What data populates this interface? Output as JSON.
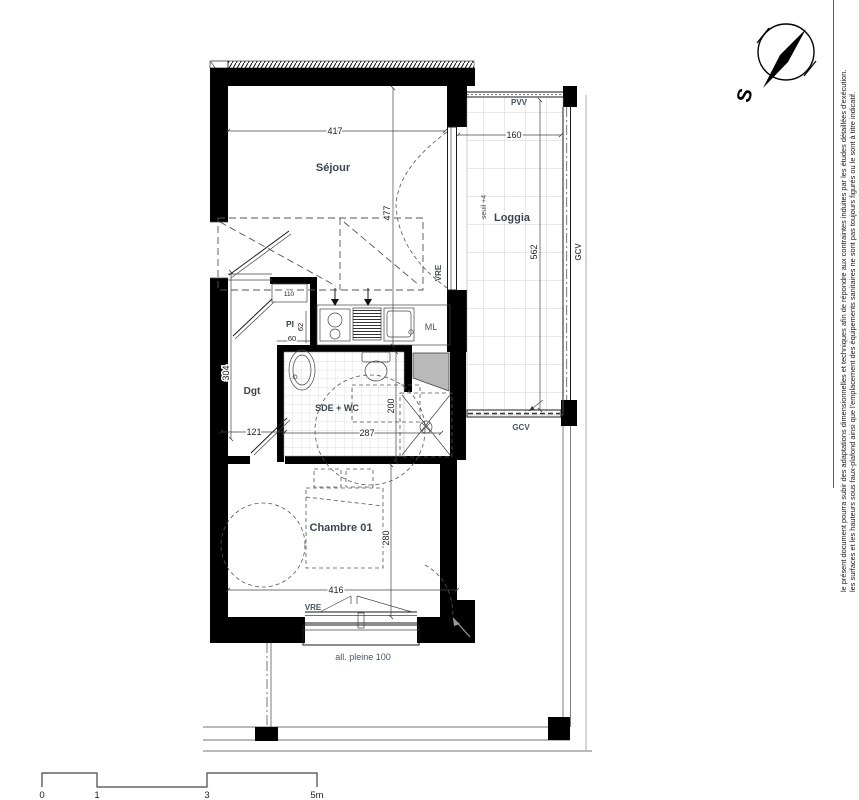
{
  "plan": {
    "rooms": {
      "sejour": "Séjour",
      "loggia": "Loggia",
      "chambre": "Chambre 01",
      "sde": "SDE + WC",
      "dgt": "Dgt",
      "pi": "PI"
    },
    "labels": {
      "ml": "ML",
      "pvv": "PVV",
      "vre": "VRE",
      "gcv": "GCV",
      "seuil": "seuil +4",
      "allege": "all. pleine 100",
      "niche": "110"
    },
    "dimensions": {
      "sejour_w": "417",
      "sejour_d": "477",
      "loggia_w": "160",
      "loggia_d": "562",
      "dgt_d": "304",
      "dgt_w": "121",
      "pi_w": "60",
      "pi_d": "62",
      "sde_w": "287",
      "sde_d": "200",
      "chambre_w": "416",
      "chambre_d": "280"
    }
  },
  "compass": {
    "south": "S"
  },
  "scale_bar": {
    "t0": "0",
    "t1": "1",
    "t3": "3",
    "t5": "5m"
  },
  "disclaimer": {
    "line1": "le présent document pourra subir des adaptations dimensionnelles et techniques afin de répondre aux contraintes induites par les études détaillées d'exécution.",
    "line2": "les surfaces et les hauteurs sous faux-plafond ainsi que l'emplacement des équipements sanitaires ne sont pas toujours figurés ou le sont à titre indicatif."
  }
}
